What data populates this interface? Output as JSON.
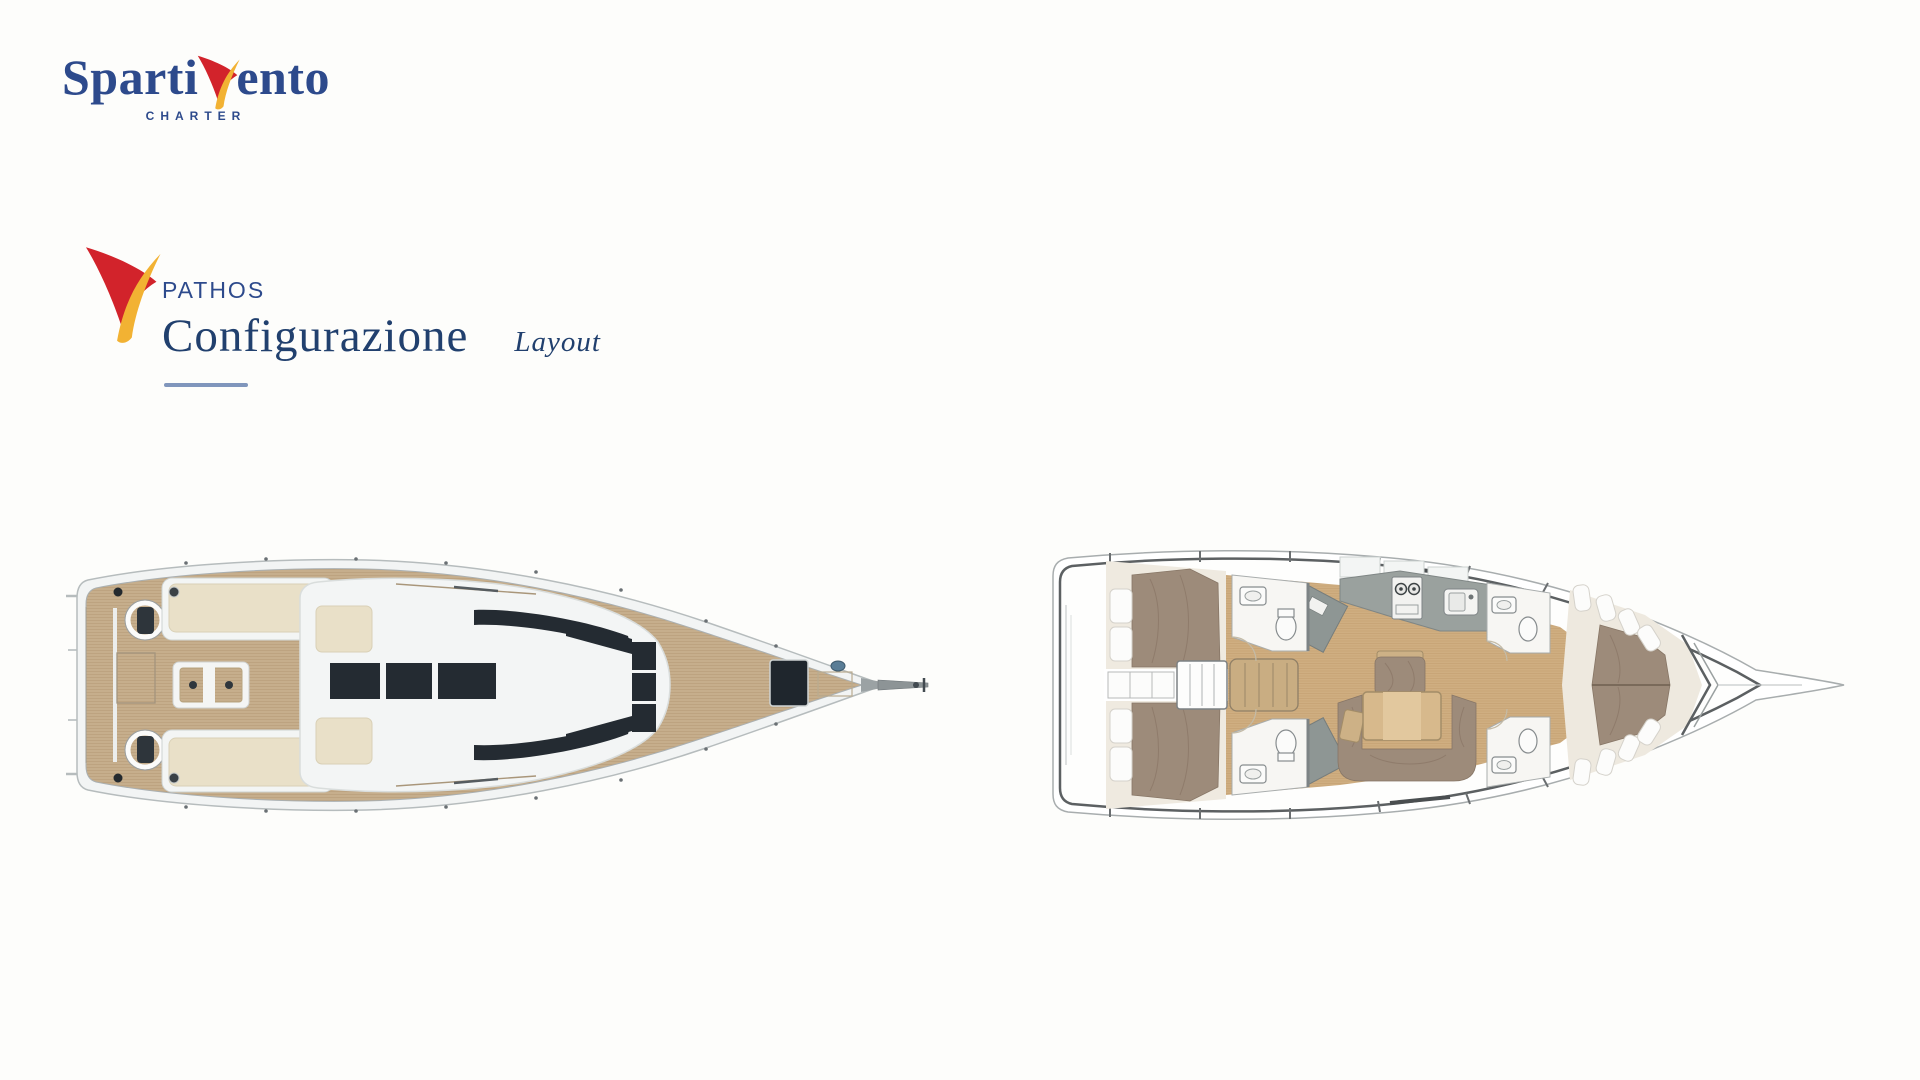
{
  "brand": {
    "name_part1": "Sparti",
    "name_part2": "ento",
    "tagline": "CHARTER"
  },
  "section": {
    "eyebrow": "PATHOS",
    "title": "Configurazione",
    "subtitle": "Layout"
  },
  "colors": {
    "page_bg": "#fdfdfb",
    "brand_blue": "#2d4a8c",
    "brand_red": "#d2232b",
    "brand_yellow": "#f2b233",
    "title_navy": "#21406e",
    "underline_blue": "#8096bc",
    "teak": "#c6ae8c",
    "hull_white": "#f2f4f4",
    "glass": "#242b32",
    "cream": "#e9e0c8",
    "floor": "#cfae81",
    "bed": "#9d8b7a",
    "wall_gray": "#9aa19e",
    "plan_line": "#5c6062"
  },
  "icons": {
    "sail_logo": "sail-logo-icon"
  }
}
